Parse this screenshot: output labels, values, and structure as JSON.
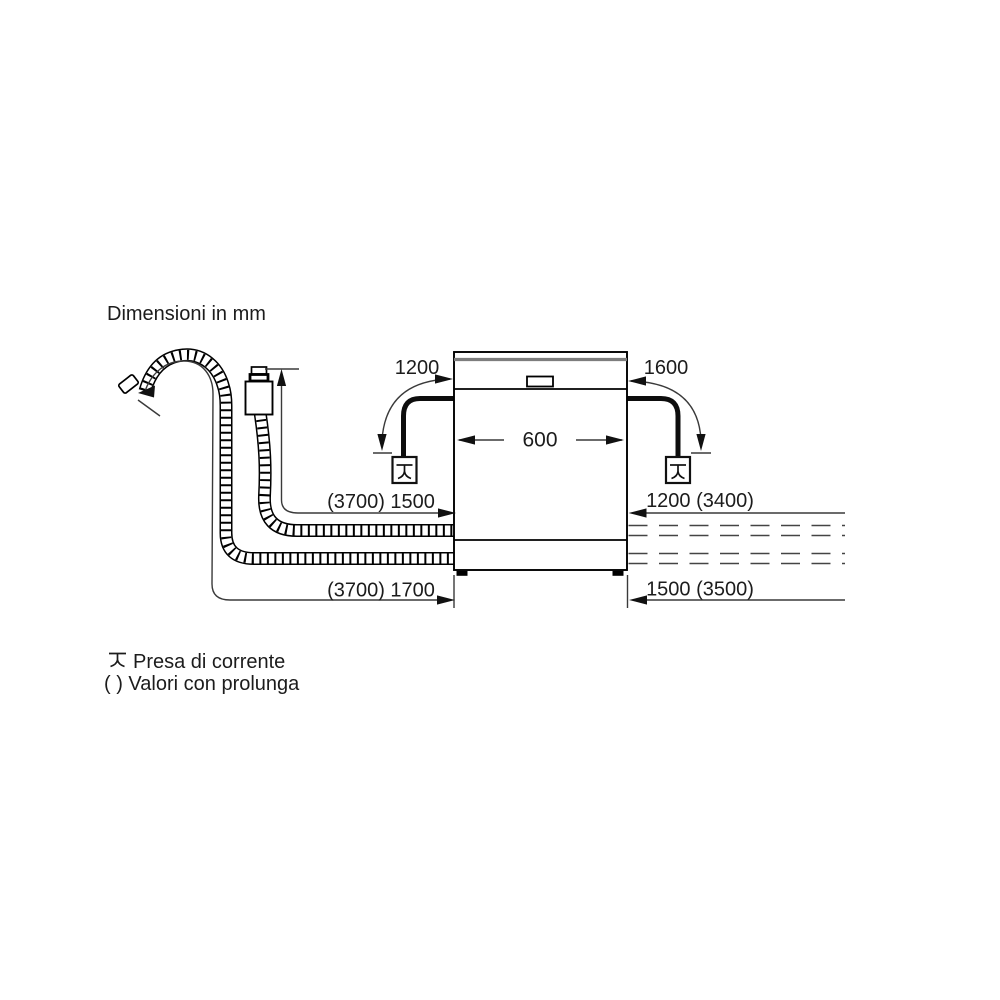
{
  "title": "Dimensioni in mm",
  "dimensions": {
    "top_left": "1200",
    "top_right": "1600",
    "appliance_width": "600",
    "left_upper": "(3700) 1500",
    "left_lower": "(3700) 1700",
    "right_upper": "1200 (3400)",
    "right_lower": "1500 (3500)"
  },
  "legend": {
    "socket_label": "Presa di corrente",
    "extension_label": "( ) Valori con prolunga"
  },
  "colors": {
    "background": "#ffffff",
    "outline": "#000000",
    "dimension_line": "#3a3a3a",
    "text": "#1c1c1c"
  }
}
